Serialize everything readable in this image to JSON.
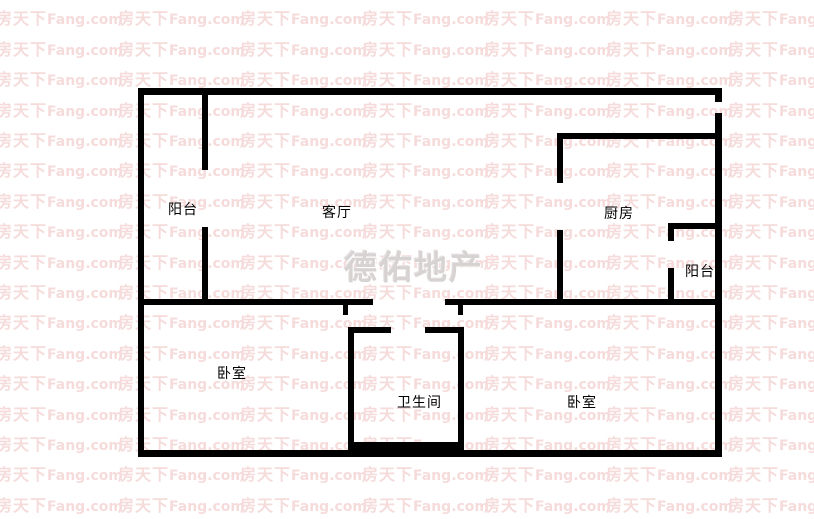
{
  "page": {
    "background": "#ffffff"
  },
  "watermark": {
    "cjk": "房天下",
    "latin": "Fang.com",
    "color": "#f6dbdb",
    "grid": {
      "cols": 7,
      "rows": 18,
      "col_width": 122,
      "row_height": 30.4,
      "x_offset": -4,
      "y_offset": -22
    }
  },
  "brand_watermark": {
    "text": "德佑地产",
    "color": "#d8d3d3"
  },
  "floorplan": {
    "wall_color": "#000000",
    "label_color": "#000000",
    "rooms": [
      {
        "id": "balcony-left",
        "label": "阳台"
      },
      {
        "id": "living-room",
        "label": "客厅"
      },
      {
        "id": "kitchen",
        "label": "厨房"
      },
      {
        "id": "balcony-right",
        "label": "阳台"
      },
      {
        "id": "bedroom-left",
        "label": "卧室"
      },
      {
        "id": "bathroom",
        "label": "卫生间"
      },
      {
        "id": "bedroom-right",
        "label": "卧室"
      }
    ]
  }
}
